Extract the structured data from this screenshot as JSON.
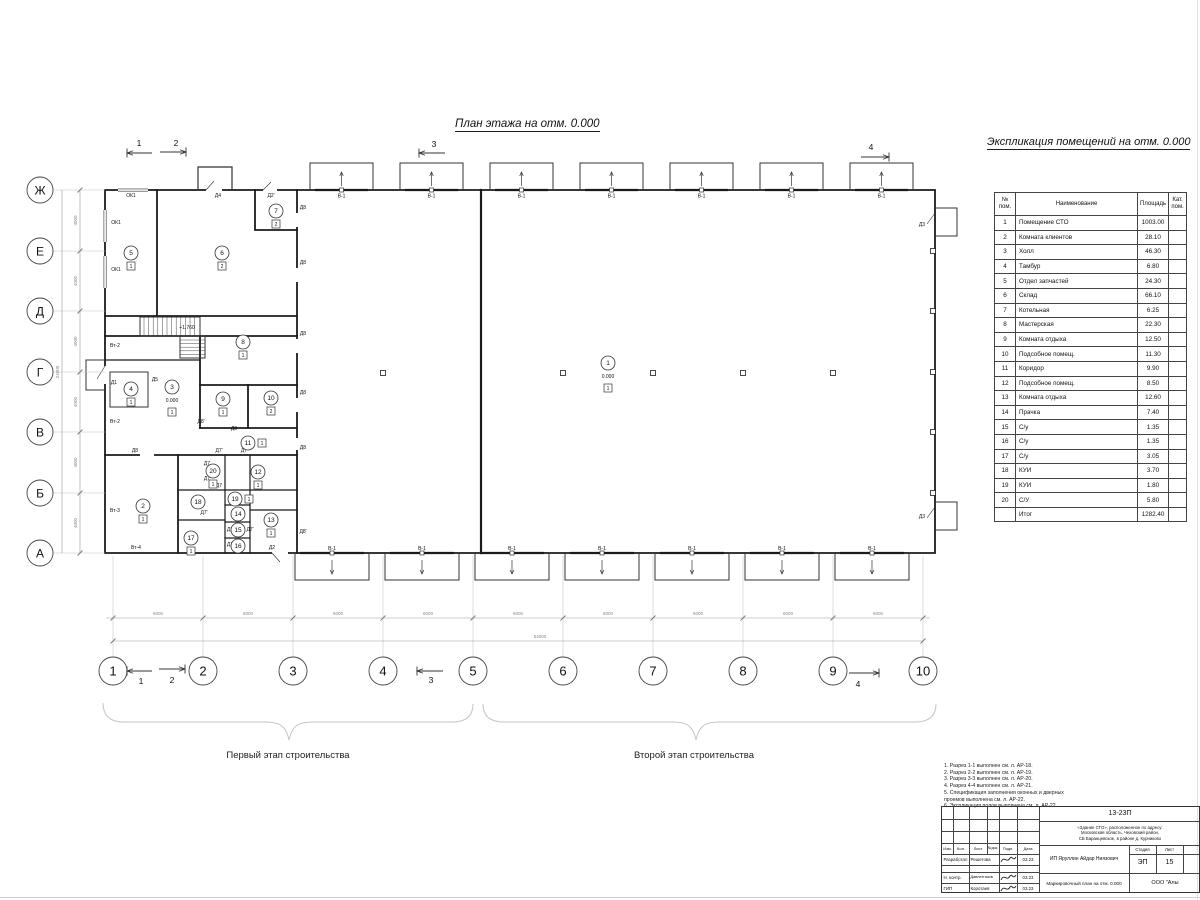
{
  "titles": {
    "plan": "План этажа на отм. 0.000",
    "legend": "Экспликация помещений на отм. 0.000"
  },
  "stages": {
    "first": "Первый этап строительства",
    "second": "Второй этап строительства"
  },
  "axes": {
    "cols": [
      "1",
      "2",
      "3",
      "4",
      "5",
      "6",
      "7",
      "8",
      "9",
      "10"
    ],
    "rows": [
      "Ж",
      "Е",
      "Д",
      "Г",
      "В",
      "Б",
      "А"
    ],
    "col_dim": "6000",
    "col_total": "54000",
    "row_dim": "4000",
    "row_total": "24000"
  },
  "gate_label": "В-1",
  "level_mark": "0.000",
  "section_marks": [
    {
      "t": "1",
      "tx": 139,
      "ty": 146,
      "y": 153,
      "x1": 152,
      "x2": 127
    },
    {
      "t": "2",
      "tx": 176,
      "ty": 146,
      "y": 152,
      "x1": 160,
      "x2": 186
    },
    {
      "t": "3",
      "tx": 434,
      "ty": 147,
      "y": 153,
      "x1": 445,
      "x2": 419
    },
    {
      "t": "4",
      "tx": 871,
      "ty": 150,
      "y": 157,
      "x1": 861,
      "x2": 889
    },
    {
      "t": "1",
      "tx": 141,
      "ty": 684,
      "y": 671,
      "x1": 152,
      "x2": 127
    },
    {
      "t": "2",
      "tx": 172,
      "ty": 683,
      "y": 669,
      "x1": 159,
      "x2": 185
    },
    {
      "t": "3",
      "tx": 431,
      "ty": 683,
      "y": 671,
      "x1": 443,
      "x2": 417
    },
    {
      "t": "4",
      "tx": 858,
      "ty": 687,
      "y": 673,
      "x1": 849,
      "x2": 879
    }
  ],
  "plan_labels": [
    {
      "t": "ОК1",
      "x": 131,
      "y": 197
    },
    {
      "t": "ОК1",
      "x": 116,
      "y": 224
    },
    {
      "t": "ОК1",
      "x": 116,
      "y": 271
    },
    {
      "t": "Д4",
      "x": 218,
      "y": 197
    },
    {
      "t": "Д2'",
      "x": 271,
      "y": 197
    },
    {
      "t": "Д8",
      "x": 303,
      "y": 209
    },
    {
      "t": "Д8",
      "x": 303,
      "y": 264
    },
    {
      "t": "Д8",
      "x": 303,
      "y": 335
    },
    {
      "t": "Д8",
      "x": 303,
      "y": 394
    },
    {
      "t": "Д8",
      "x": 303,
      "y": 449
    },
    {
      "t": "Д8'",
      "x": 303,
      "y": 533
    },
    {
      "t": "Д8'",
      "x": 201,
      "y": 423
    },
    {
      "t": "Д8",
      "x": 234,
      "y": 430
    },
    {
      "t": "Д8",
      "x": 135,
      "y": 452
    },
    {
      "t": "Д1",
      "x": 114,
      "y": 384
    },
    {
      "t": "Д5",
      "x": 155,
      "y": 381
    },
    {
      "t": "Д2",
      "x": 272,
      "y": 549
    },
    {
      "t": "Д3",
      "x": 922,
      "y": 226
    },
    {
      "t": "Д3",
      "x": 922,
      "y": 518
    },
    {
      "t": "Вт-2",
      "x": 115,
      "y": 347
    },
    {
      "t": "Вт-2",
      "x": 115,
      "y": 423
    },
    {
      "t": "Вт-3",
      "x": 115,
      "y": 512
    },
    {
      "t": "Вт-4",
      "x": 136,
      "y": 549
    },
    {
      "t": "+1.760",
      "x": 187,
      "y": 329
    },
    {
      "t": "Д7'",
      "x": 219,
      "y": 452
    },
    {
      "t": "Д7",
      "x": 244,
      "y": 452
    },
    {
      "t": "Д7",
      "x": 207,
      "y": 465
    },
    {
      "t": "Д7",
      "x": 207,
      "y": 480
    },
    {
      "t": "Д7",
      "x": 219,
      "y": 487
    },
    {
      "t": "Д7'",
      "x": 204,
      "y": 514
    },
    {
      "t": "Д7",
      "x": 230,
      "y": 531
    },
    {
      "t": "Д7'",
      "x": 250,
      "y": 531
    },
    {
      "t": "Д7",
      "x": 230,
      "y": 546
    }
  ],
  "rooms": [
    {
      "n": "1",
      "x": 608,
      "y": 363,
      "level": "0.000",
      "tag": "1"
    },
    {
      "n": "2",
      "x": 143,
      "y": 506,
      "tag": "1"
    },
    {
      "n": "3",
      "x": 172,
      "y": 387,
      "level": "0.000",
      "tag": "1"
    },
    {
      "n": "4",
      "x": 131,
      "y": 389,
      "tag": "1"
    },
    {
      "n": "5",
      "x": 131,
      "y": 253,
      "tag": "1"
    },
    {
      "n": "6",
      "x": 222,
      "y": 253,
      "tag": "2"
    },
    {
      "n": "7",
      "x": 276,
      "y": 211,
      "tag": "2"
    },
    {
      "n": "8",
      "x": 243,
      "y": 342,
      "tag": "1"
    },
    {
      "n": "9",
      "x": 223,
      "y": 399,
      "tag": "1"
    },
    {
      "n": "10",
      "x": 271,
      "y": 398,
      "tag": "2"
    },
    {
      "n": "11",
      "x": 248,
      "y": 443,
      "tag": "1",
      "side": true
    },
    {
      "n": "12",
      "x": 258,
      "y": 472,
      "tag": "1"
    },
    {
      "n": "13",
      "x": 271,
      "y": 520,
      "tag": "1"
    },
    {
      "n": "14",
      "x": 238,
      "y": 514
    },
    {
      "n": "15",
      "x": 238,
      "y": 530
    },
    {
      "n": "16",
      "x": 238,
      "y": 546
    },
    {
      "n": "17",
      "x": 191,
      "y": 538,
      "tag": "1"
    },
    {
      "n": "18",
      "x": 198,
      "y": 502
    },
    {
      "n": "19",
      "x": 235,
      "y": 499,
      "tag": "1",
      "side": true
    },
    {
      "n": "20",
      "x": 213,
      "y": 471,
      "tag": "1"
    }
  ],
  "room_table": {
    "headers": [
      "№ пом.",
      "Наименование",
      "Площадь",
      "Кат.\nпом."
    ],
    "rows": [
      [
        "1",
        "Помещение СТО",
        "1003.00"
      ],
      [
        "2",
        "Комната клиентов",
        "28.10"
      ],
      [
        "3",
        "Холл",
        "46.30"
      ],
      [
        "4",
        "Тамбур",
        "6.80"
      ],
      [
        "5",
        "Отдел запчастей",
        "24.30"
      ],
      [
        "6",
        "Склад",
        "66.10"
      ],
      [
        "7",
        "Котельная",
        "6.25"
      ],
      [
        "8",
        "Мастерская",
        "22.30"
      ],
      [
        "9",
        "Комната отдыха",
        "12.50"
      ],
      [
        "10",
        "Подсобное помещ.",
        "11.30"
      ],
      [
        "11",
        "Коридор",
        "9.90"
      ],
      [
        "12",
        "Подсобное помещ.",
        "8.50"
      ],
      [
        "13",
        "Комната отдыха",
        "12.60"
      ],
      [
        "14",
        "Прачка",
        "7.40"
      ],
      [
        "15",
        "С/у",
        "1.35"
      ],
      [
        "16",
        "С/у",
        "1.35"
      ],
      [
        "17",
        "С/у",
        "3.05"
      ],
      [
        "18",
        "КУИ",
        "3.70"
      ],
      [
        "19",
        "КУИ",
        "1.80"
      ],
      [
        "20",
        "С/У",
        "5.80"
      ]
    ],
    "total": [
      "",
      "Итог",
      "1282.40"
    ]
  },
  "notes": [
    "1. Разрез 1-1 выполнен см. л. АР-18.",
    "2. Разрез 2-2 выполнен см. л. АР-19.",
    "3. Разрез 3-3 выполнен см. л. АР-20.",
    "4. Разрез 4-4 выполнен см. л. АР-21.",
    "5. Спецификация заполнения оконных и дверных",
    "    проемов выполнена см. л. АР-22.",
    "6. Экспликация полов выполнена см. л. АР-22."
  ],
  "title_block": {
    "doc_number": "13-23П",
    "address_lines": [
      "«Здание СТО», расположенное по адресу:",
      "Московская область, Чеховский район,",
      "СБ Баранцевское, в районе д. Курниково"
    ],
    "columns": [
      "Изм.",
      "Кол.",
      "Лист",
      "№док.",
      "Подп.",
      "Дата"
    ],
    "rows": [
      {
        "role": "Разработал",
        "name": "Решетова",
        "date": "03.23"
      },
      {
        "role": "Н. контр.",
        "name": "Давлетгазов",
        "date": "03.23"
      },
      {
        "role": "ГИП",
        "name": "Коротаев",
        "date": "03.23"
      }
    ],
    "client": "ИП Яруллин Айдар Ниязович",
    "sheet_title": "Маркировочный план на отм. 0.000",
    "stage_label": "Стадия",
    "list_label": "Лист",
    "stage": "ЭП",
    "list": "15",
    "company": "ООО \"Алы"
  }
}
